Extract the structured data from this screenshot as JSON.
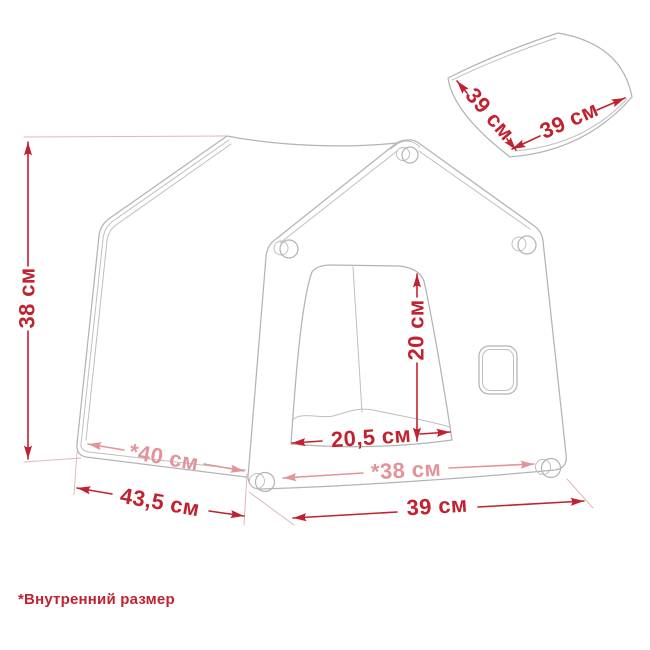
{
  "diagram_type": "product-dimensions",
  "units": "см",
  "colors": {
    "dimension_primary": "#c1222f",
    "dimension_internal": "#e2949a",
    "extension_line": "#e0b6ba",
    "drawing_outline": "#b4b4b6",
    "background": "#ffffff"
  },
  "house": {
    "height": "38 см",
    "depth_outer": "43,5 см",
    "depth_inner": "*40 см",
    "door_width": "20,5 см",
    "door_height": "20 см",
    "width_inner": "*38 см",
    "width_outer": "39 см"
  },
  "cushion": {
    "width": "39 см",
    "depth": "39 см"
  },
  "footnote": {
    "text": "*Внутренний размер"
  }
}
